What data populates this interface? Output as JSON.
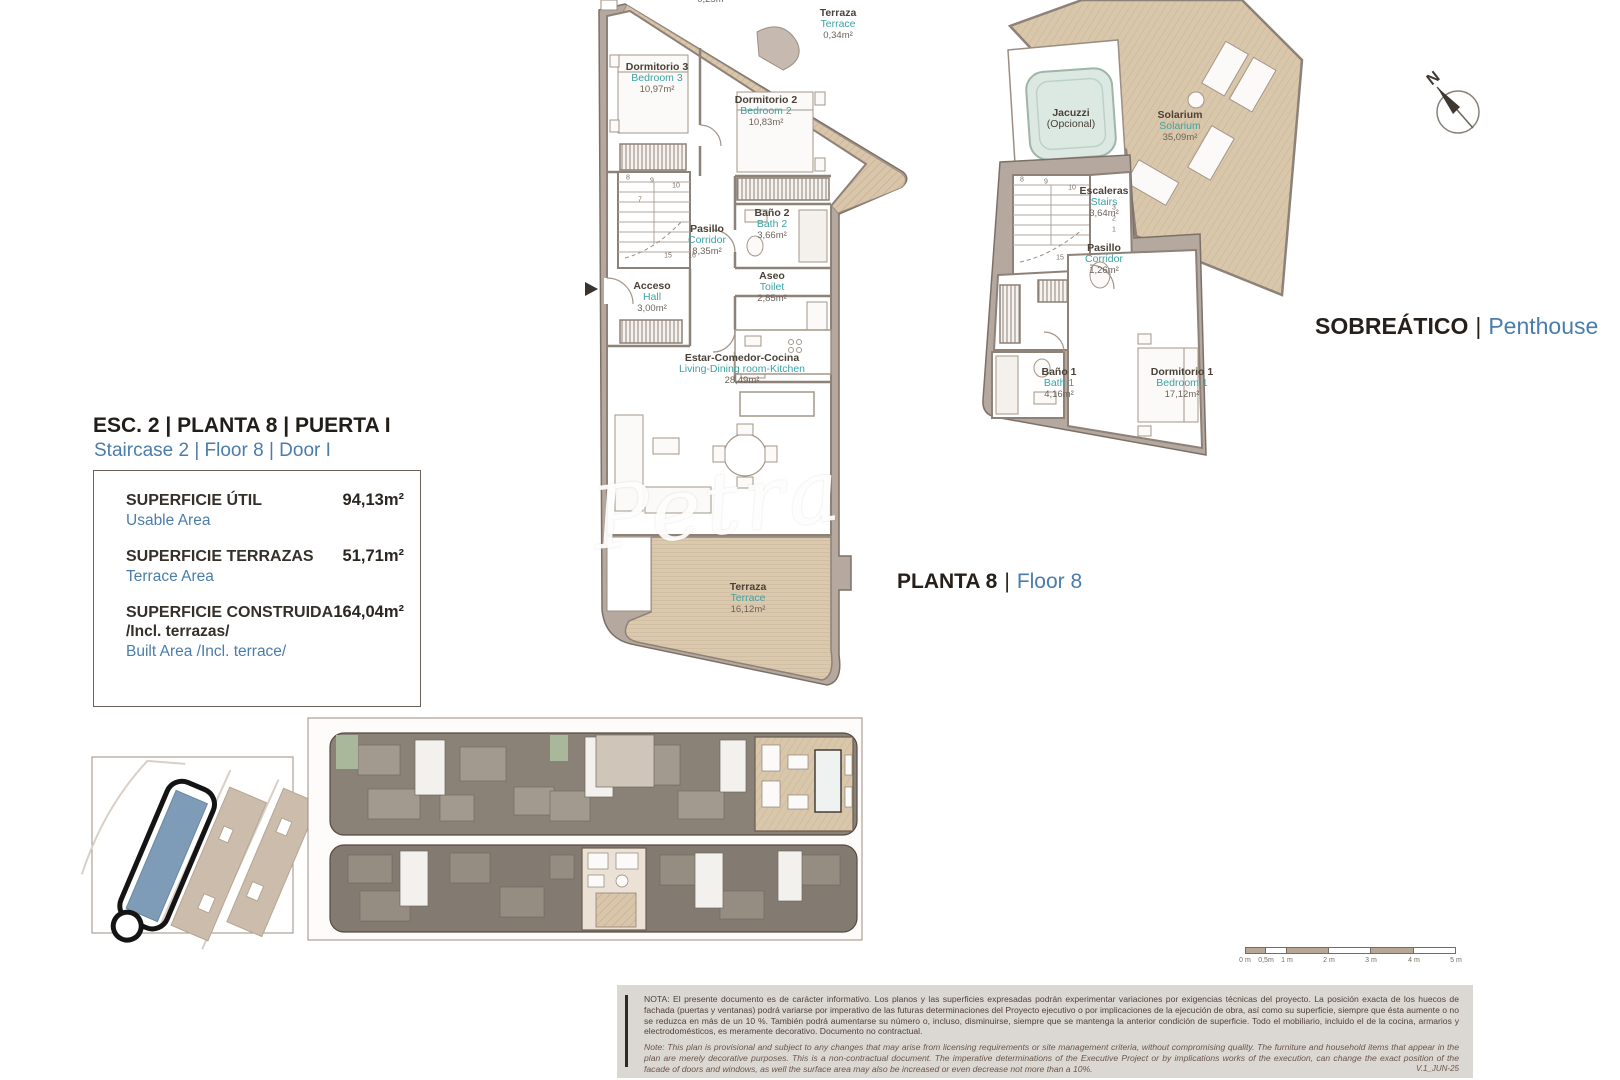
{
  "sep": "|",
  "watermark": {
    "text": "Petra"
  },
  "compass": {
    "label": "N"
  },
  "header": {
    "title": "ESC. 2 | PLANTA 8 | PUERTA I",
    "subtitle": "Staircase 2 | Floor 8 | Door I"
  },
  "area_table": {
    "rows": [
      {
        "label_es": "SUPERFICIE ÚTIL",
        "label_en": "Usable Area",
        "value": "94,13m²"
      },
      {
        "label_es": "SUPERFICIE TERRAZAS",
        "label_en": "Terrace Area",
        "value": "51,71m²"
      },
      {
        "label_es": "SUPERFICIE CONSTRUIDA",
        "label_es2": "/Incl. terrazas/",
        "label_en": "Built Area /Incl. terrace/",
        "value": "164,04m²"
      }
    ]
  },
  "plans": {
    "floor8": {
      "caption_es": "PLANTA 8",
      "caption_en": "Floor 8",
      "rooms": [
        {
          "es": "Terraza",
          "en": "Terrace",
          "area": "0,25m²"
        },
        {
          "es": "Terraza",
          "en": "Terrace",
          "area": "0,34m²"
        },
        {
          "es": "Dormitorio 3",
          "en": "Bedroom 3",
          "area": "10,97m²"
        },
        {
          "es": "Dormitorio 2",
          "en": "Bedroom 2",
          "area": "10,83m²"
        },
        {
          "es": "Pasillo",
          "en": "Corridor",
          "area": "8,35m²"
        },
        {
          "es": "Baño 2",
          "en": "Bath 2",
          "area": "3,66m²"
        },
        {
          "es": "Aseo",
          "en": "Toilet",
          "area": "2,85m²"
        },
        {
          "es": "Acceso",
          "en": "Hall",
          "area": "3,00m²"
        },
        {
          "es": "Estar-Comedor-Cocina",
          "en": "Living-Dining room-Kitchen",
          "area": "28,49m²"
        },
        {
          "es": "Terraza",
          "en": "Terrace",
          "area": "16,12m²"
        }
      ],
      "stair_numbers": [
        "8",
        "9",
        "10",
        "7",
        "15",
        "16"
      ]
    },
    "penthouse": {
      "caption_es": "SOBREÁTICO",
      "caption_en": "Penthouse",
      "rooms": [
        {
          "es": "Jacuzzi",
          "en": "(Opcional)"
        },
        {
          "es": "Solarium",
          "en": "Solarium",
          "area": "35,09m²"
        },
        {
          "es": "Escaleras",
          "en": "Stairs",
          "area": "3,64m²"
        },
        {
          "es": "Pasillo",
          "en": "Corridor",
          "area": "1,26m²"
        },
        {
          "es": "Baño 1",
          "en": "Bath 1",
          "area": "4,16m²"
        },
        {
          "es": "Dormitorio 1",
          "en": "Bedroom 1",
          "area": "17,12m²"
        }
      ],
      "stair_numbers": [
        "8",
        "9",
        "10",
        "3",
        "2",
        "1",
        "15"
      ]
    }
  },
  "scale_bar": {
    "labels": [
      "0 m",
      "0,5m",
      "1 m",
      "2 m",
      "3 m",
      "4 m",
      "5 m"
    ]
  },
  "disclaimer": {
    "note_es": "NOTA: El presente documento es de carácter informativo. Los planos y las superficies expresadas podrán experimentar variaciones por exigencias técnicas del proyecto. La posición exacta de los huecos de fachada (puertas y ventanas) podrá variarse por imperativo de las futuras determinaciones del Proyecto ejecutivo o por implicaciones de la ejecución de obra, así como su superficie, siempre que ésta aumente o no se reduzca en más de un 10 %. También podrá aumentarse su número o, incluso, disminuirse, siempre que se mantenga la anterior condición de superficie. Todo el mobiliario, incluido el de la cocina, armarios y electrodomésticos, es meramente decorativo. Documento no contractual.",
    "note_en": "Note: This plan is provisional and subject to any changes that may arise from licensing requirements or site management criteria, without compromising quality. The furniture and household items that appear in the plan are merely decorative purposes. This is a non-contractual document. The imperative determinations of the Executive Project or by implications works of the execution, can change the exact position of the facade of doors and windows, as well the surface area may also be increased or even decrease not more than a 10%.",
    "version": "V.1_JUN-25"
  },
  "colors": {
    "accent_blue": "#4a7dab",
    "teal": "#3aa3a6",
    "wall": "#b5a99f",
    "terrace": "#d8c5aa",
    "site_highlight": "#7e9cb7"
  }
}
